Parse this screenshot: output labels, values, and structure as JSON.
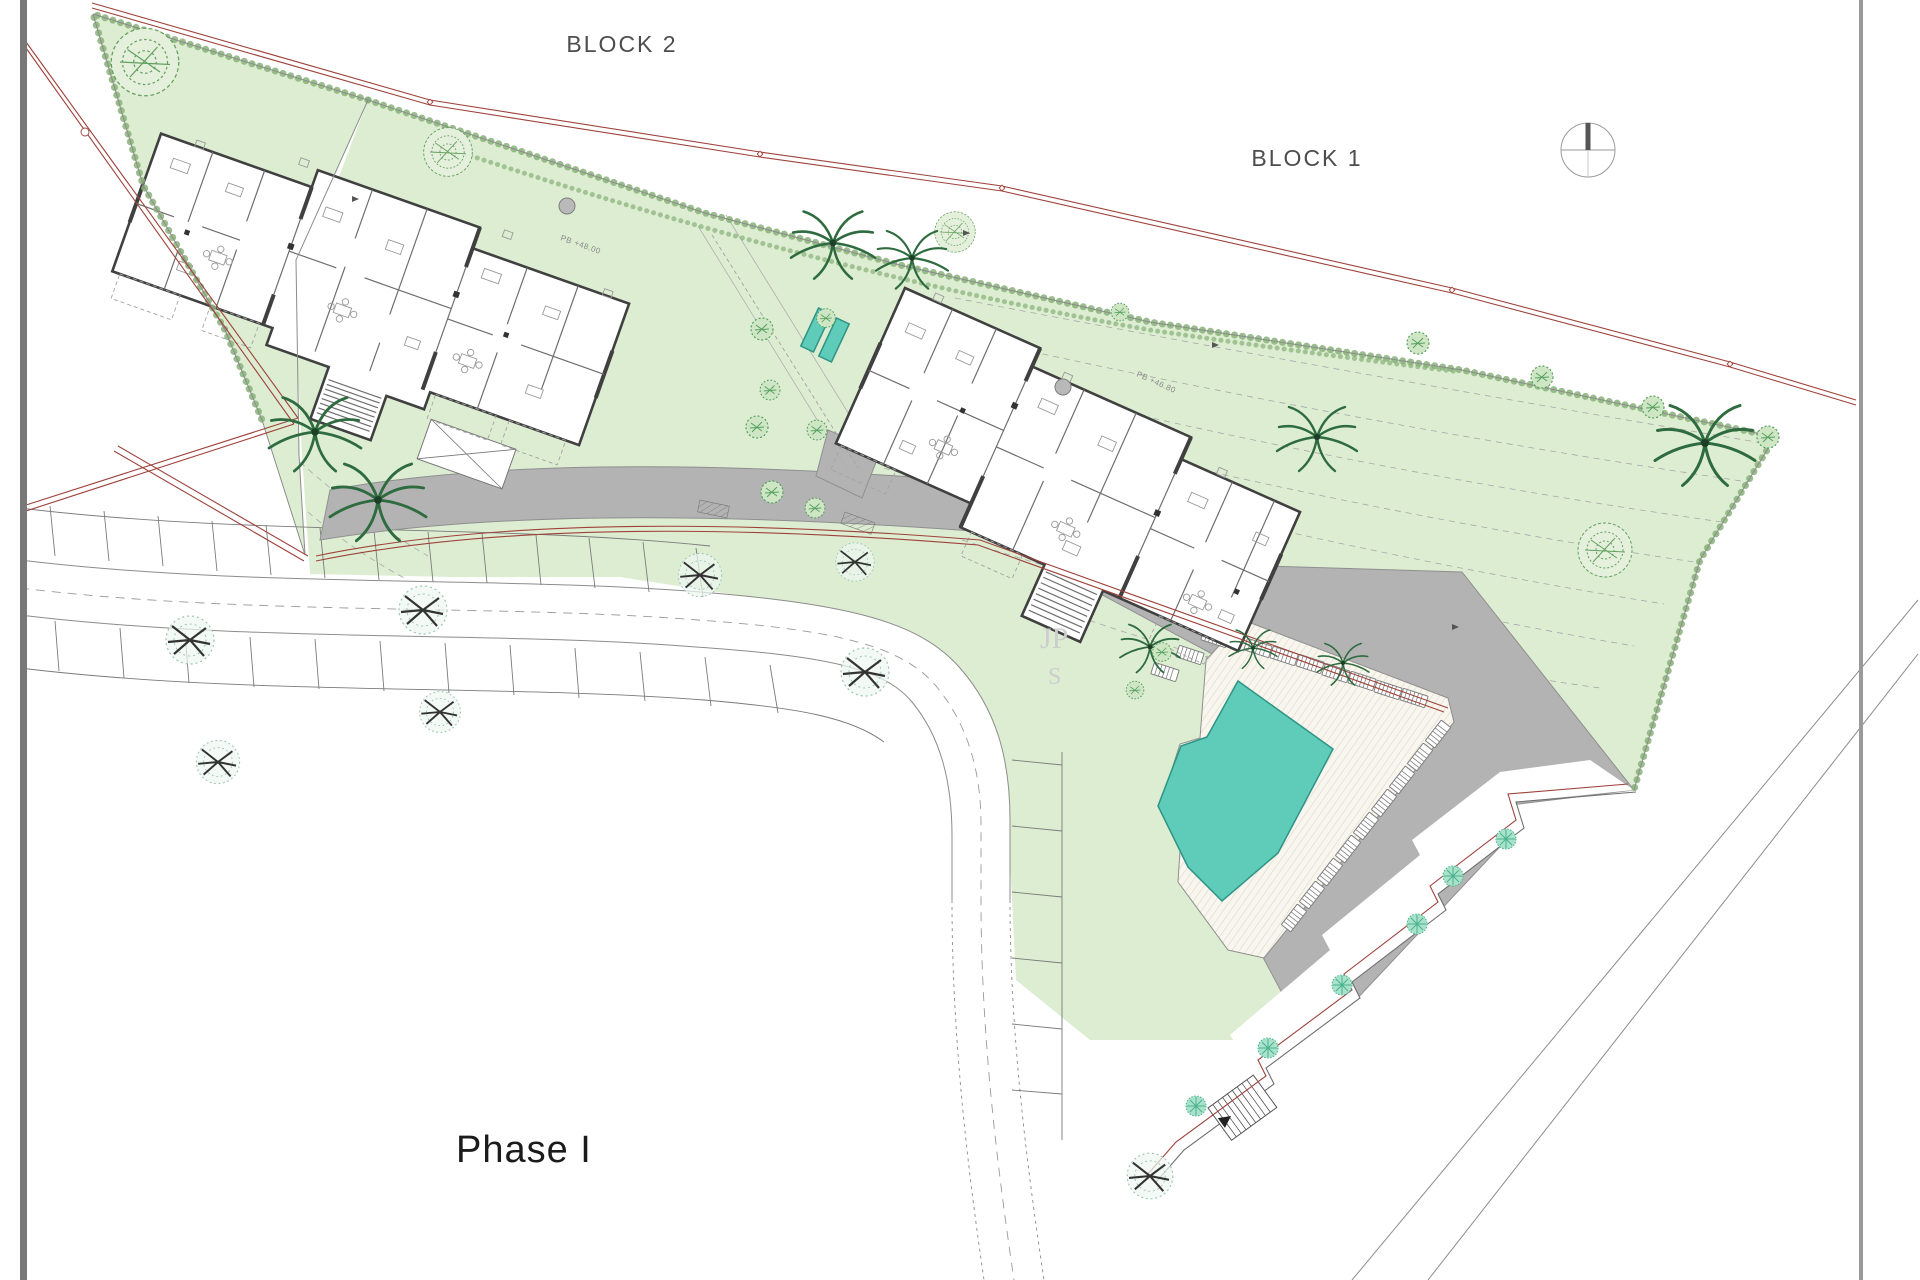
{
  "page": {
    "type": "architectural-site-plan",
    "background": "#ffffff"
  },
  "labels": {
    "block2": "BLOCK 2",
    "block1": "BLOCK 1",
    "phase": "Phase I"
  },
  "annotations": {
    "block2_level": "PB +48.00",
    "block1_level": "PB +46.80",
    "watermark_top": "JP",
    "watermark_bottom": "S"
  },
  "icons": [
    {
      "name": "north-compass-icon",
      "meaning": "north orientation compass"
    },
    {
      "name": "palm-tree-icon",
      "meaning": "palm tree"
    },
    {
      "name": "round-tree-icon",
      "meaning": "garden tree"
    },
    {
      "name": "street-tree-icon",
      "meaning": "street tree"
    },
    {
      "name": "mint-tree-icon",
      "meaning": "walkway tree"
    },
    {
      "name": "sun-lounger-icon",
      "meaning": "pool sun lounger"
    }
  ],
  "colors": {
    "pool": "#5fccba",
    "pool_border": "#2f9486",
    "grass": "#ddedd2",
    "grass_edge": "#88b179",
    "road": "#b3b3b3",
    "road_edge": "#8f8f8f",
    "boundary_red": "#9e423b",
    "building_wall": "#404040",
    "detail_gray": "#9a9a9a",
    "tree_green": "#55a061",
    "palm_green": "#2e6b3f",
    "mint_tree": "#49b28d",
    "deck_stripe": "#ded8c6",
    "label_text": "#4d4d4d",
    "phase_text": "#1b1b1b",
    "watermark": "#cdcdcd"
  }
}
